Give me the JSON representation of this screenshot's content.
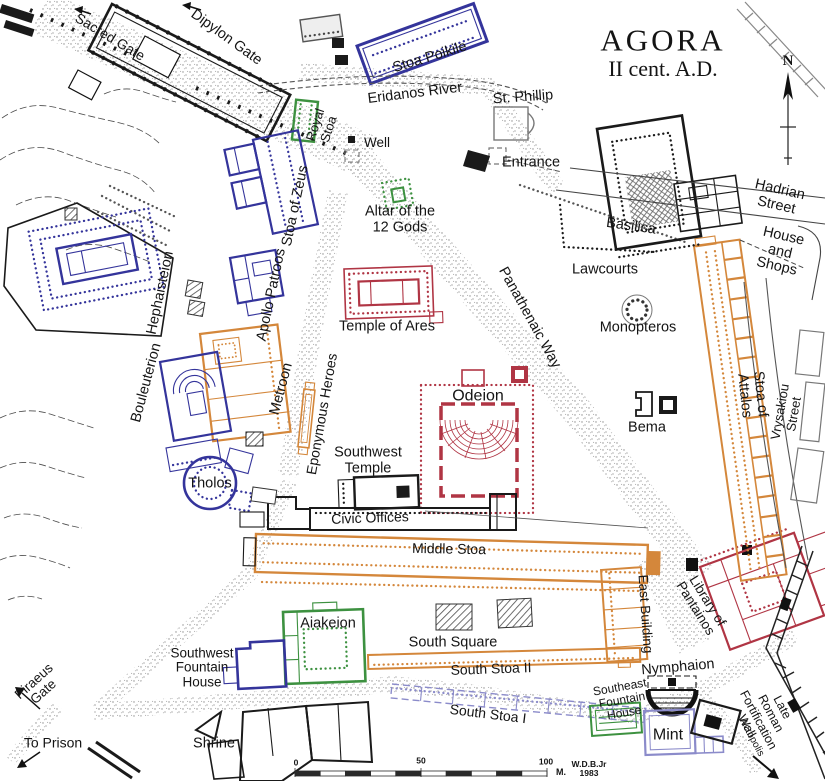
{
  "map": {
    "name": "Plan of the Athenian Agora",
    "title": "AGORA",
    "subtitle": "II cent. A.D.",
    "compass": "N",
    "scale_unit": "M.",
    "scale_ticks": [
      "0",
      "50",
      "100"
    ],
    "credit": "W.D.B.Jr 1983"
  },
  "colors": {
    "navy": "#34349b",
    "green": "#3d9140",
    "orange": "#d4873b",
    "crimson": "#b03544",
    "light_purple": "#8b8bca",
    "ink": "#1a1a1a",
    "road_dot": "#8e8e8e",
    "gray": "#666666"
  },
  "map_labels": [
    {
      "id": "sacred-gate",
      "text": "Sacred Gate",
      "x": 110,
      "y": 37,
      "rot": 31,
      "size": 14
    },
    {
      "id": "dipylon-gate",
      "text": "Dipylon Gate",
      "x": 226,
      "y": 38,
      "rot": 36,
      "size": 14.5
    },
    {
      "id": "stoa-poikile",
      "text": "Stoa Poikile",
      "x": 430,
      "y": 58,
      "rot": -17,
      "size": 14.5
    },
    {
      "id": "eridanos-river",
      "text": "Eridanos River",
      "x": 415,
      "y": 94,
      "rot": -7,
      "size": 14.5
    },
    {
      "id": "st-phillip",
      "text": "St. Phillip",
      "x": 523,
      "y": 98,
      "rot": -4,
      "size": 14.5
    },
    {
      "id": "royal-stoa",
      "text": "Royal\nStoa",
      "x": 322,
      "y": 127,
      "rot": -72,
      "size": 13
    },
    {
      "id": "well",
      "text": "Well",
      "x": 377,
      "y": 143,
      "rot": 0,
      "size": 13.5
    },
    {
      "id": "entrance",
      "text": "Entrance",
      "x": 531,
      "y": 163,
      "rot": 0,
      "size": 14.5
    },
    {
      "id": "agora-title",
      "text": "AGORA",
      "x": 663,
      "y": 40,
      "rot": 0,
      "size": 31,
      "cls": "serif ls"
    },
    {
      "id": "agora-subtitle",
      "text": "II cent. A.D.",
      "x": 663,
      "y": 69,
      "rot": 0,
      "size": 22,
      "cls": "serif"
    },
    {
      "id": "compass-n",
      "text": "N",
      "x": 788,
      "y": 61,
      "rot": 0,
      "size": 15,
      "cls": "serif bold"
    },
    {
      "id": "hadrian-street",
      "text": "Hadrian Street",
      "x": 778,
      "y": 198,
      "rot": 13,
      "size": 14.5
    },
    {
      "id": "basilica",
      "text": "Basilica",
      "x": 631,
      "y": 227,
      "rot": 8,
      "size": 14.5
    },
    {
      "id": "house-and-shops",
      "text": "House\nand Shops",
      "x": 780,
      "y": 252,
      "rot": 13,
      "size": 14.5
    },
    {
      "id": "lawcourts",
      "text": "Lawcourts",
      "x": 605,
      "y": 270,
      "rot": 0,
      "size": 14.5
    },
    {
      "id": "altar-of-the-12-gods",
      "text": "Altar of the\n12 Gods",
      "x": 400,
      "y": 220,
      "rot": 0,
      "size": 14.5
    },
    {
      "id": "stoa-of-zeus",
      "text": "Stoa of Zeus",
      "x": 296,
      "y": 206,
      "rot": -78,
      "size": 14.5
    },
    {
      "id": "apollo-patroos",
      "text": "Apollo Patroos",
      "x": 272,
      "y": 295,
      "rot": -78,
      "size": 14.5
    },
    {
      "id": "hephaisteion",
      "text": "Hephaisteion",
      "x": 161,
      "y": 293,
      "rot": -78,
      "size": 14.5
    },
    {
      "id": "temple-of-ares",
      "text": "Temple of Ares",
      "x": 387,
      "y": 327,
      "rot": 0,
      "size": 14.5
    },
    {
      "id": "panathenaic-way",
      "text": "Panathenaic Way",
      "x": 529,
      "y": 318,
      "rot": 61,
      "size": 14.5
    },
    {
      "id": "monopteros",
      "text": "Monopteros",
      "x": 638,
      "y": 328,
      "rot": 0,
      "size": 14.5
    },
    {
      "id": "bouleuterion",
      "text": "Bouleuterion",
      "x": 147,
      "y": 383,
      "rot": -75,
      "size": 14.5
    },
    {
      "id": "metroon",
      "text": "Metroon",
      "x": 282,
      "y": 389,
      "rot": -75,
      "size": 14.5
    },
    {
      "id": "eponymous-heroes",
      "text": "Eponymous Heroes",
      "x": 322,
      "y": 414,
      "rot": -80,
      "size": 14
    },
    {
      "id": "odeion",
      "text": "Odeion",
      "x": 478,
      "y": 396,
      "rot": 0,
      "size": 16
    },
    {
      "id": "bema",
      "text": "Bema",
      "x": 647,
      "y": 428,
      "rot": 0,
      "size": 14.5
    },
    {
      "id": "stoa-of-attalos",
      "text": "Stoa of Attalos",
      "x": 752,
      "y": 395,
      "rot": 84,
      "size": 14.5
    },
    {
      "id": "vrysakiou-street",
      "text": "Vrysakiou Street",
      "x": 787,
      "y": 413,
      "rot": -80,
      "size": 13
    },
    {
      "id": "tholos",
      "text": "Tholos",
      "x": 210,
      "y": 484,
      "rot": 0,
      "size": 14.5
    },
    {
      "id": "southwest-temple",
      "text": "Southwest\nTemple",
      "x": 368,
      "y": 461,
      "rot": 0,
      "size": 14.5
    },
    {
      "id": "civic-offices",
      "text": "Civic Offices",
      "x": 370,
      "y": 518,
      "rot": -2,
      "size": 14
    },
    {
      "id": "middle-stoa",
      "text": "Middle Stoa",
      "x": 449,
      "y": 549,
      "rot": 1,
      "size": 14
    },
    {
      "id": "east-building",
      "text": "East Building",
      "x": 645,
      "y": 614,
      "rot": 86,
      "size": 13.5
    },
    {
      "id": "library-of-pantainos",
      "text": "Library of\nPantainos",
      "x": 701,
      "y": 605,
      "rot": 58,
      "size": 13.5
    },
    {
      "id": "aiakeion",
      "text": "Aiakeion",
      "x": 328,
      "y": 624,
      "rot": 0,
      "size": 14.5
    },
    {
      "id": "south-square",
      "text": "South Square",
      "x": 453,
      "y": 643,
      "rot": 0,
      "size": 14.5
    },
    {
      "id": "south-stoa-ii",
      "text": "South Stoa II",
      "x": 491,
      "y": 669,
      "rot": -2,
      "size": 14
    },
    {
      "id": "southwest-fountain-house",
      "text": "Southwest\nFountain\nHouse",
      "x": 202,
      "y": 668,
      "rot": 0,
      "size": 13.5
    },
    {
      "id": "nymphaion",
      "text": "Nymphaion",
      "x": 678,
      "y": 668,
      "rot": -5,
      "size": 14.5
    },
    {
      "id": "southeast-fountain-house",
      "text": "Southeast\nFountain\nHouse",
      "x": 622,
      "y": 700,
      "rot": -10,
      "size": 12
    },
    {
      "id": "south-stoa-i",
      "text": "South Stoa I",
      "x": 488,
      "y": 714,
      "rot": 7,
      "size": 14
    },
    {
      "id": "piraeus-gate",
      "text": "Piraeus\nGate",
      "x": 39,
      "y": 687,
      "rot": -42,
      "size": 13.5
    },
    {
      "id": "to-prison",
      "text": "To Prison",
      "x": 53,
      "y": 743,
      "rot": 0,
      "size": 14
    },
    {
      "id": "shrine",
      "text": "Shrine",
      "x": 214,
      "y": 744,
      "rot": 0,
      "size": 14.5
    },
    {
      "id": "mint",
      "text": "Mint",
      "x": 668,
      "y": 735,
      "rot": 0,
      "size": 16
    },
    {
      "id": "late-roman-wall",
      "text": "Late Roman\nFortification Wall",
      "x": 764,
      "y": 717,
      "rot": 62,
      "size": 12.5
    },
    {
      "id": "acropolis",
      "text": "Acropolis",
      "x": 751,
      "y": 738,
      "rot": 62,
      "size": 10
    },
    {
      "id": "credit",
      "text": "W.D.B.Jr\n1983",
      "x": 589,
      "y": 769,
      "rot": 0,
      "size": 8.5,
      "cls": "bold"
    },
    {
      "id": "scale-0",
      "text": "0",
      "x": 296,
      "y": 763,
      "rot": 0,
      "size": 8.5,
      "cls": "bold"
    },
    {
      "id": "scale-50",
      "text": "50",
      "x": 421,
      "y": 761,
      "rot": 0,
      "size": 8.5,
      "cls": "bold"
    },
    {
      "id": "scale-100",
      "text": "100",
      "x": 546,
      "y": 762,
      "rot": 0,
      "size": 8.5,
      "cls": "bold"
    },
    {
      "id": "scale-m",
      "text": "M.",
      "x": 561,
      "y": 773,
      "rot": 0,
      "size": 9,
      "cls": "bold"
    }
  ]
}
